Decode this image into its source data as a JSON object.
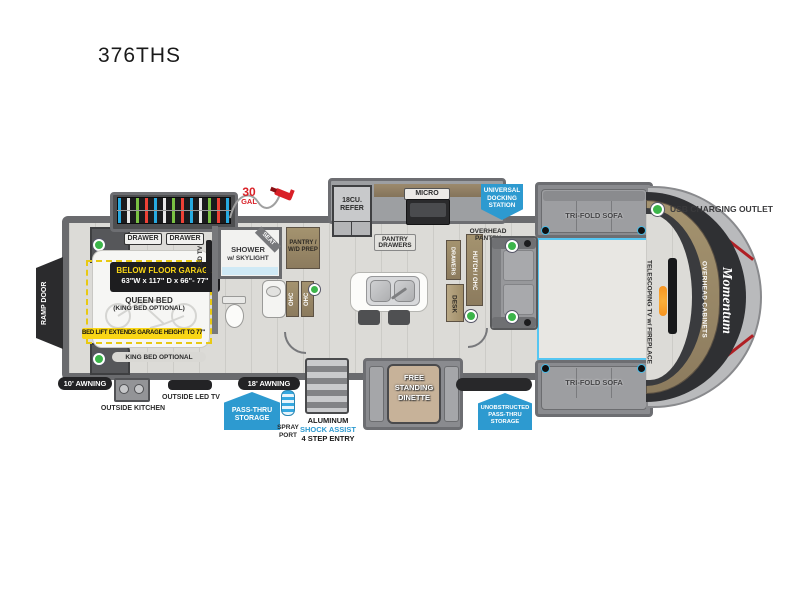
{
  "title": "376THS",
  "legend": {
    "usb_label": "USB CHARGING OUTLET"
  },
  "exterior": {
    "ramp_door": "RAMP DOOR",
    "awning_rear": "10' AWNING",
    "awning_main": "18' AWNING",
    "outside_kitchen": "OUTSIDE KITCHEN",
    "outside_tv": "OUTSIDE LED TV",
    "spray_line1": "SPRAY",
    "spray_line2": "PORT",
    "entry_line1": "ALUMINUM",
    "entry_line2": "SHOCK ASSIST",
    "entry_line3": "4 STEP ENTRY",
    "passthru_line1": "PASS-THRU",
    "passthru_line2": "STORAGE",
    "unob_line1": "UNOBSTRUCTED",
    "unob_line2": "PASS-THRU",
    "unob_line3": "STORAGE",
    "dock_line1": "UNIVERSAL",
    "dock_line2": "DOCKING",
    "dock_line3": "STATION",
    "fuel_qty": "30",
    "fuel_unit": "GAL"
  },
  "garage": {
    "drawer_left": "DRAWER",
    "drawer_right": "DRAWER",
    "below_floor": "BELOW FLOOR GARAGE",
    "dims": "63\"W x 117\" D x 66\"- 77\"",
    "bed_line1": "QUEEN BED",
    "bed_line2": "(KING BED OPTIONAL)",
    "bed_lift": "BED LIFT EXTENDS GARAGE HEIGHT TO 77\"",
    "king_option": "KING BED OPTIONAL",
    "led_tv": "LED TV"
  },
  "bath": {
    "shower_line1": "SHOWER",
    "shower_line2": "w/ SKYLIGHT",
    "seat": "SEAT",
    "pantry_line1": "PANTRY /",
    "pantry_line2": "W/D PREP",
    "ohc_left": "OHC",
    "ohc_right": "OHC"
  },
  "kitchen": {
    "refer_line1": "18CU.",
    "refer_line2": "REFER",
    "micro": "MICRO",
    "pantry_drawers_line1": "PANTRY",
    "pantry_drawers_line2": "DRAWERS",
    "overhead_line1": "OVERHEAD",
    "overhead_line2": "PANTRY",
    "drawers": "DRAWERS",
    "hutch": "HUTCH / OHC",
    "desk": "DESK"
  },
  "living": {
    "sofa_top": "TRI-FOLD SOFA",
    "sofa_bottom": "TRI-FOLD SOFA",
    "tv_line1": "TELESCOPING TV",
    "tv_line2": "w/ FIREPLACE",
    "overhead_cabinets": "OVERHEAD CABINETS",
    "brand": "Momentum"
  },
  "dinette": {
    "line1": "FREE",
    "line2": "STANDING",
    "line3": "DINETTE"
  },
  "colors": {
    "accent_cyan": "#45bdea",
    "badge_blue": "#2d9ad0",
    "highlight_yellow": "#f9d616",
    "usb_green": "#3cb54a",
    "alert_red": "#d92027"
  }
}
